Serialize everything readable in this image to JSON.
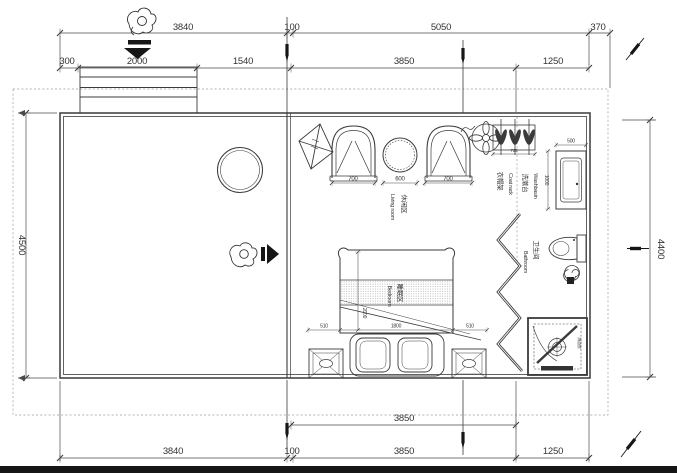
{
  "title": "floor-plan-drawing",
  "dims": {
    "top1": [
      "3840",
      "100",
      "5050",
      "370"
    ],
    "top2": [
      "300",
      "2000",
      "1540",
      "3850",
      "1250"
    ],
    "left": "4500",
    "right": "4400",
    "bottom1": "3850",
    "bottom2": [
      "3840",
      "100",
      "3850",
      "1250"
    ],
    "living": [
      "700",
      "600",
      "700"
    ],
    "coat_rack": "725",
    "washbasin": [
      "500",
      "1000"
    ],
    "bed": [
      "510",
      "1800",
      "510",
      "2000"
    ]
  },
  "rooms": {
    "living": {
      "cn": "休闲区",
      "en": "Living room"
    },
    "bedroom": {
      "cn": "睡眠区",
      "en": "Bedroom"
    },
    "bathroom": {
      "cn": "卫生间",
      "en": "Bathroom"
    },
    "coat_rack": {
      "cn": "衣帽架",
      "en": "Coat rack"
    },
    "washbasin": {
      "cn": "洗漱台",
      "en": "Washbasin"
    },
    "shower": {
      "cn": "淋浴房"
    }
  },
  "colors": {
    "line": "#3b3b3b",
    "muted": "#8f8f8f",
    "dark": "#161616",
    "paper": "#ffffff"
  }
}
